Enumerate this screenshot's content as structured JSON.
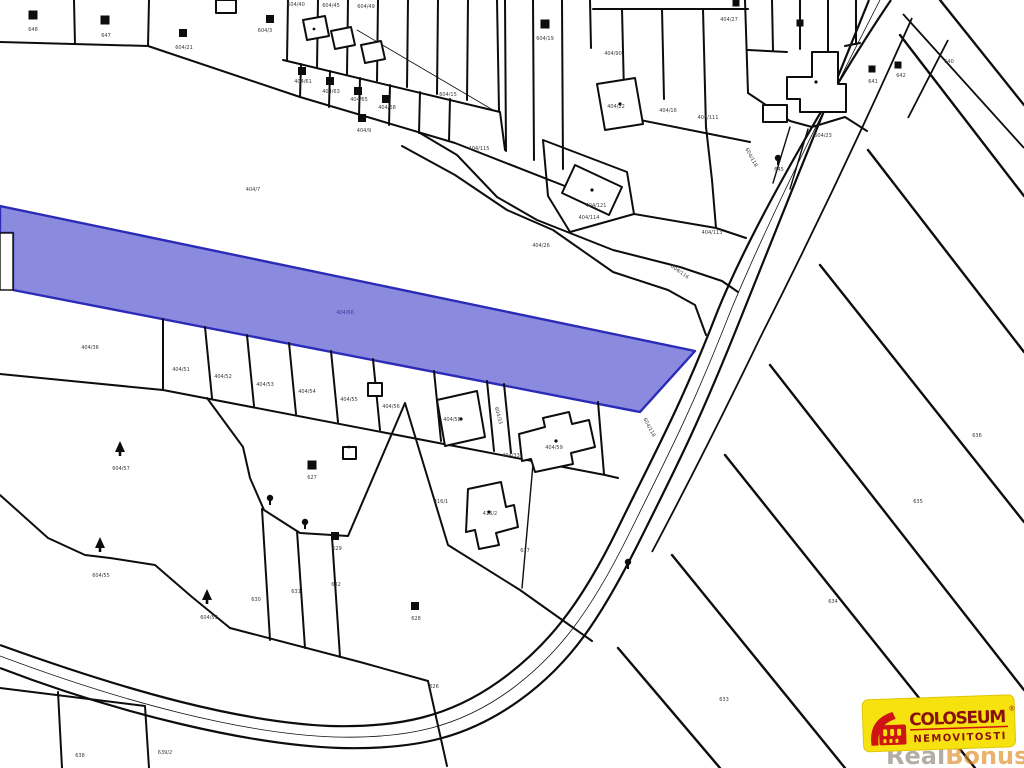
{
  "map": {
    "type": "cadastral-map",
    "background": "#ffffff",
    "line_color": "#0d0d0d",
    "highlight": {
      "fill": "#8a8ade",
      "stroke": "#2b2bb8",
      "label": "404/66",
      "label_x": 345,
      "label_y": 314
    },
    "parcel_labels": [
      {
        "t": "604/40",
        "x": 296,
        "y": 6
      },
      {
        "t": "604/45",
        "x": 331,
        "y": 7
      },
      {
        "t": "604/49",
        "x": 366,
        "y": 8
      },
      {
        "t": "648",
        "x": 33,
        "y": 31
      },
      {
        "t": "647",
        "x": 106,
        "y": 37
      },
      {
        "t": "604/21",
        "x": 184,
        "y": 49
      },
      {
        "t": "604/3",
        "x": 265,
        "y": 32
      },
      {
        "t": "404/61",
        "x": 303,
        "y": 83
      },
      {
        "t": "404/63",
        "x": 331,
        "y": 93
      },
      {
        "t": "404/65",
        "x": 359,
        "y": 101
      },
      {
        "t": "404/68",
        "x": 387,
        "y": 109
      },
      {
        "t": "404/9",
        "x": 364,
        "y": 132
      },
      {
        "t": "404/7",
        "x": 253,
        "y": 191
      },
      {
        "t": "604/15",
        "x": 448,
        "y": 96
      },
      {
        "t": "404/115",
        "x": 479,
        "y": 150
      },
      {
        "t": "404/90",
        "x": 613,
        "y": 55
      },
      {
        "t": "404/22",
        "x": 616,
        "y": 108
      },
      {
        "t": "404/16",
        "x": 668,
        "y": 112
      },
      {
        "t": "404/111",
        "x": 708,
        "y": 119
      },
      {
        "t": "404/27",
        "x": 729,
        "y": 21
      },
      {
        "t": "604/19",
        "x": 545,
        "y": 40
      },
      {
        "t": "404/121",
        "x": 596,
        "y": 207
      },
      {
        "t": "404/114",
        "x": 589,
        "y": 219
      },
      {
        "t": "404/113",
        "x": 712,
        "y": 234
      },
      {
        "t": "404/26",
        "x": 541,
        "y": 247
      },
      {
        "t": "604/116",
        "x": 679,
        "y": 273,
        "r": 35
      },
      {
        "t": "604/118",
        "x": 750,
        "y": 158,
        "r": 62
      },
      {
        "t": "604/118",
        "x": 648,
        "y": 428,
        "r": 62
      },
      {
        "t": "641",
        "x": 873,
        "y": 83
      },
      {
        "t": "642",
        "x": 901,
        "y": 77
      },
      {
        "t": "645",
        "x": 779,
        "y": 171
      },
      {
        "t": "640",
        "x": 949,
        "y": 63
      },
      {
        "t": "604/23",
        "x": 823,
        "y": 137
      },
      {
        "t": "404/36",
        "x": 90,
        "y": 349
      },
      {
        "t": "404/51",
        "x": 181,
        "y": 371
      },
      {
        "t": "404/52",
        "x": 223,
        "y": 378
      },
      {
        "t": "404/53",
        "x": 265,
        "y": 386
      },
      {
        "t": "404/54",
        "x": 307,
        "y": 393
      },
      {
        "t": "404/55",
        "x": 349,
        "y": 401
      },
      {
        "t": "404/56",
        "x": 391,
        "y": 408
      },
      {
        "t": "404/58",
        "x": 452,
        "y": 421
      },
      {
        "t": "604/33",
        "x": 497,
        "y": 416,
        "r": 75
      },
      {
        "t": "404/33",
        "x": 511,
        "y": 457
      },
      {
        "t": "404/59",
        "x": 554,
        "y": 449
      },
      {
        "t": "416/1",
        "x": 441,
        "y": 503
      },
      {
        "t": "416/2",
        "x": 490,
        "y": 515
      },
      {
        "t": "637",
        "x": 525,
        "y": 552
      },
      {
        "t": "627",
        "x": 312,
        "y": 479
      },
      {
        "t": "628",
        "x": 416,
        "y": 620
      },
      {
        "t": "629",
        "x": 337,
        "y": 550
      },
      {
        "t": "604/57",
        "x": 121,
        "y": 470
      },
      {
        "t": "604/55",
        "x": 101,
        "y": 577
      },
      {
        "t": "604/53",
        "x": 209,
        "y": 619
      },
      {
        "t": "630",
        "x": 256,
        "y": 601
      },
      {
        "t": "631",
        "x": 296,
        "y": 593
      },
      {
        "t": "632",
        "x": 336,
        "y": 586
      },
      {
        "t": "626",
        "x": 434,
        "y": 688
      },
      {
        "t": "638",
        "x": 80,
        "y": 757
      },
      {
        "t": "639/2",
        "x": 165,
        "y": 754
      },
      {
        "t": "636",
        "x": 977,
        "y": 437
      },
      {
        "t": "635",
        "x": 918,
        "y": 503
      },
      {
        "t": "634",
        "x": 833,
        "y": 603
      },
      {
        "t": "633",
        "x": 724,
        "y": 701
      }
    ],
    "black_buildings": [
      {
        "x": 33,
        "y": 15,
        "s": 9
      },
      {
        "x": 105,
        "y": 20,
        "s": 9
      },
      {
        "x": 183,
        "y": 33,
        "s": 8
      },
      {
        "x": 270,
        "y": 19,
        "s": 8
      },
      {
        "x": 302,
        "y": 71,
        "s": 8
      },
      {
        "x": 330,
        "y": 81,
        "s": 8
      },
      {
        "x": 358,
        "y": 91,
        "s": 8
      },
      {
        "x": 386,
        "y": 99,
        "s": 8
      },
      {
        "x": 362,
        "y": 118,
        "s": 8
      },
      {
        "x": 545,
        "y": 24,
        "s": 9
      },
      {
        "x": 736,
        "y": 3,
        "s": 7
      },
      {
        "x": 800,
        "y": 23,
        "s": 7
      },
      {
        "x": 872,
        "y": 69,
        "s": 7
      },
      {
        "x": 898,
        "y": 65,
        "s": 7
      },
      {
        "x": 312,
        "y": 465,
        "s": 9
      },
      {
        "x": 335,
        "y": 536,
        "s": 8
      },
      {
        "x": 415,
        "y": 606,
        "s": 8
      }
    ],
    "conifer_trees": [
      {
        "x": 120,
        "y": 452
      },
      {
        "x": 100,
        "y": 548
      },
      {
        "x": 207,
        "y": 600
      }
    ],
    "round_trees": [
      {
        "x": 270,
        "y": 498
      },
      {
        "x": 305,
        "y": 522
      },
      {
        "x": 628,
        "y": 562
      },
      {
        "x": 778,
        "y": 158
      }
    ]
  },
  "logo": {
    "brand": "COLOSEUM",
    "registered": "®",
    "subtitle": "NEMOVITOSTI",
    "bg_color": "#f6e20e",
    "brand_color": "#8b1111",
    "accent_color": "#cf1414",
    "icon": "colosseum-icon"
  },
  "watermark": {
    "part1": "Real",
    "part2": "Bonus",
    "suffix": ".cz",
    "part1_color": "#8a8378",
    "part2_color": "#e08a1e"
  }
}
